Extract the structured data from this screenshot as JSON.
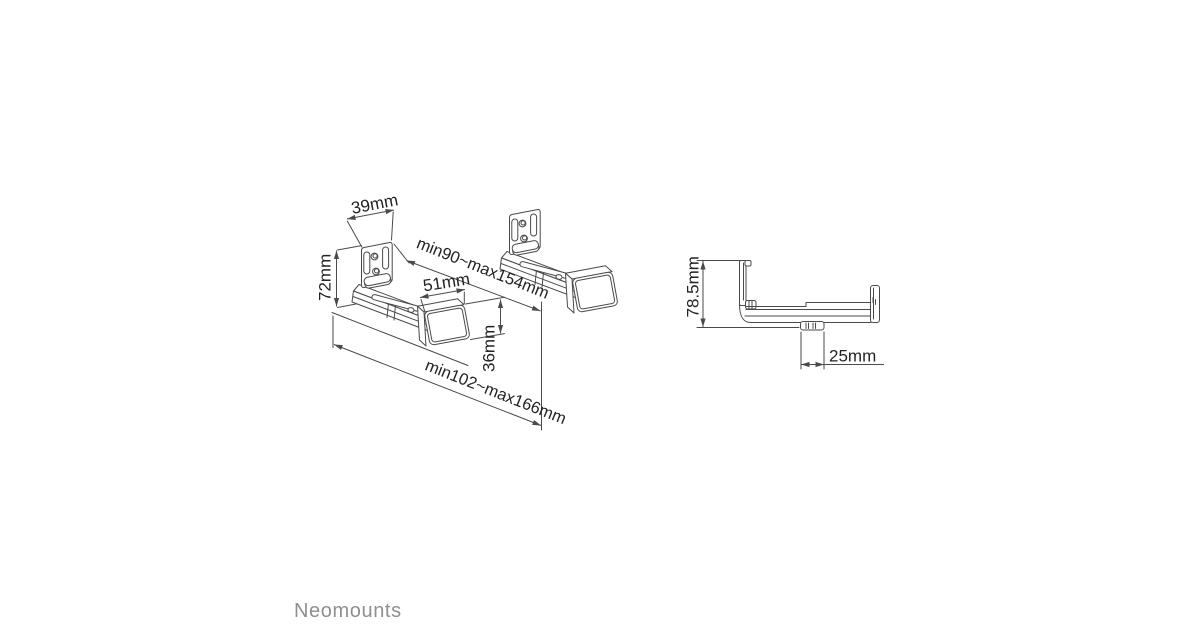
{
  "page": {
    "background": "#ffffff"
  },
  "logo": {
    "text": "Neomounts",
    "color": "#8f8f8f"
  },
  "drawing": {
    "line_color": "#4a4a4a",
    "text_color": "#232323",
    "dimensions": {
      "plate_width": "39mm",
      "bracket_height": "72mm",
      "cap_width": "51mm",
      "cap_height": "36mm",
      "depth_range_upper": "min90~max154mm",
      "depth_range_lower": "min102~max166mm",
      "side_height": "78.5mm",
      "foot_width": "25mm"
    }
  }
}
